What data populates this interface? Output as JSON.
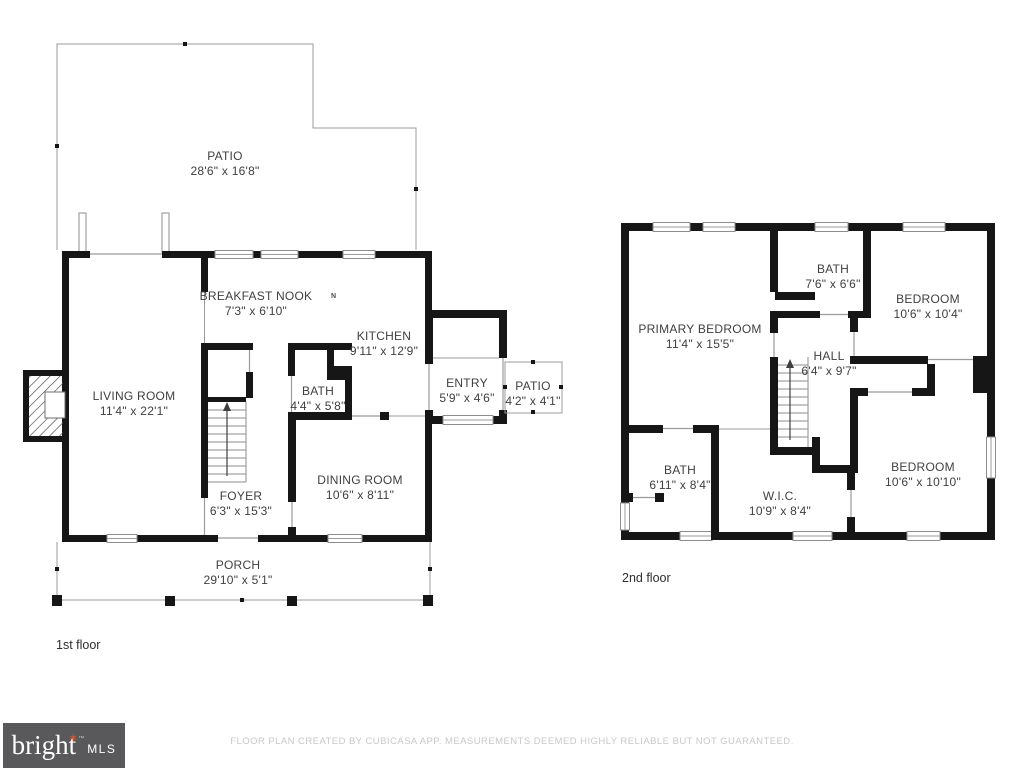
{
  "floors": {
    "first": {
      "label": "1st floor",
      "compass": "N",
      "rooms": {
        "patio_large": {
          "name": "PATIO",
          "dims": "28'6\" x 16'8\""
        },
        "breakfast_nook": {
          "name": "BREAKFAST NOOK",
          "dims": "7'3\" x 6'10\""
        },
        "kitchen": {
          "name": "KITCHEN",
          "dims": "9'11\" x 12'9\""
        },
        "living_room": {
          "name": "LIVING ROOM",
          "dims": "11'4\" x 22'1\""
        },
        "bath": {
          "name": "BATH",
          "dims": "4'4\" x 5'8\""
        },
        "entry": {
          "name": "ENTRY",
          "dims": "5'9\" x 4'6\""
        },
        "patio_small": {
          "name": "PATIO",
          "dims": "4'2\" x 4'1\""
        },
        "dining_room": {
          "name": "DINING ROOM",
          "dims": "10'6\" x 8'11\""
        },
        "foyer": {
          "name": "FOYER",
          "dims": "6'3\" x 15'3\""
        },
        "porch": {
          "name": "PORCH",
          "dims": "29'10\" x 5'1\""
        }
      }
    },
    "second": {
      "label": "2nd floor",
      "rooms": {
        "bath_top": {
          "name": "BATH",
          "dims": "7'6\" x 6'6\""
        },
        "bedroom_top": {
          "name": "BEDROOM",
          "dims": "10'6\" x 10'4\""
        },
        "primary_bedroom": {
          "name": "PRIMARY BEDROOM",
          "dims": "11'4\" x 15'5\""
        },
        "hall": {
          "name": "HALL",
          "dims": "6'4\" x 9'7\""
        },
        "bath_bottom": {
          "name": "BATH",
          "dims": "6'11\" x 8'4\""
        },
        "wic": {
          "name": "W.I.C.",
          "dims": "10'9\" x 8'4\""
        },
        "bedroom_bottom": {
          "name": "BEDROOM",
          "dims": "10'6\" x 10'10\""
        }
      }
    }
  },
  "footer": {
    "logo": {
      "brand": "bright",
      "star": "✶",
      "tm": "™",
      "suffix": "MLS",
      "bg": "#59595b",
      "text": "#ffffff",
      "accent": "#d9532c"
    },
    "disclaimer": "FLOOR PLAN CREATED BY CUBICASA APP. MEASUREMENTS DEEMED HIGHLY RELIABLE BUT NOT GUARANTEED."
  },
  "colors": {
    "wall": "#161616",
    "outline": "#9b9b9b",
    "label_text": "#3f3f3f",
    "disclaimer_text": "#c8c8c8"
  }
}
